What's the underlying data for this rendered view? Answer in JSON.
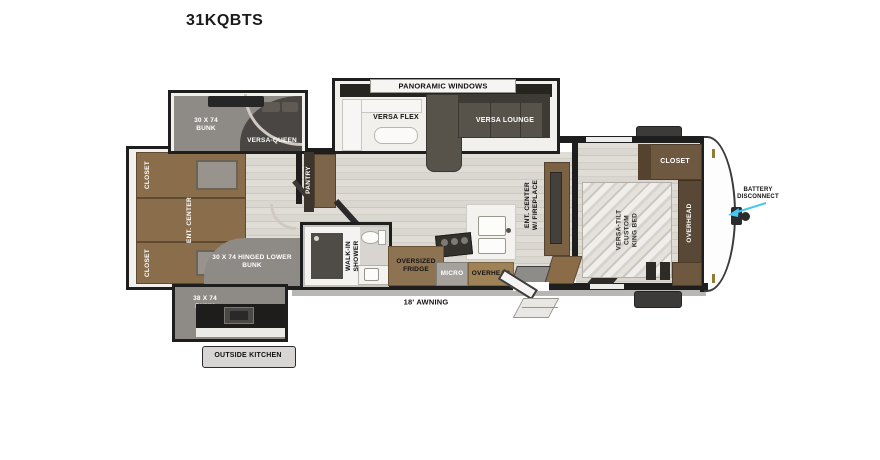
{
  "title": "31KQBTS",
  "labels": {
    "rear_closet_top": "CLOSET",
    "rear_ent_center": "ENT. CENTER",
    "rear_closet_bottom": "CLOSET",
    "upper_bunk": "30 X 74 BUNK",
    "versa_queen": "VERSA-QUEEN",
    "lower_bunk": "30 X 74 HINGED LOWER BUNK",
    "outside_bunk": "38 X 74 BUNK",
    "outside_kitchen": "OUTSIDE KITCHEN",
    "pantry": "PANTRY",
    "panoramic_windows": "PANORAMIC WINDOWS",
    "versa_flex": "VERSA FLEX",
    "versa_lounge": "VERSA LOUNGE",
    "walk_in_shower": "WALK-IN SHOWER",
    "oversized_fridge": "OVERSIZED FRIDGE",
    "micro": "MICRO",
    "kitchen_overhead": "OVERHEAD",
    "ent_center_fireplace": "ENT. CENTER W/ FIREPLACE",
    "awning": "18' AWNING",
    "bedroom_closet": "CLOSET",
    "king_bed": "VERSA-TILT CUSTOM KING BED",
    "bedroom_overhead": "OVERHEAD",
    "battery_disconnect": "BATTERY DISCONNECT"
  },
  "colors": {
    "wall": "#1e1e1e",
    "cabinet_brown": "#8a6e4c",
    "dark_cabinet": "#5a4836",
    "sofa_olive": "#57534a",
    "bunk_gray": "#8e8a85",
    "floor_light": "#d9d5cf",
    "arrow_cyan": "#45c6f5"
  }
}
